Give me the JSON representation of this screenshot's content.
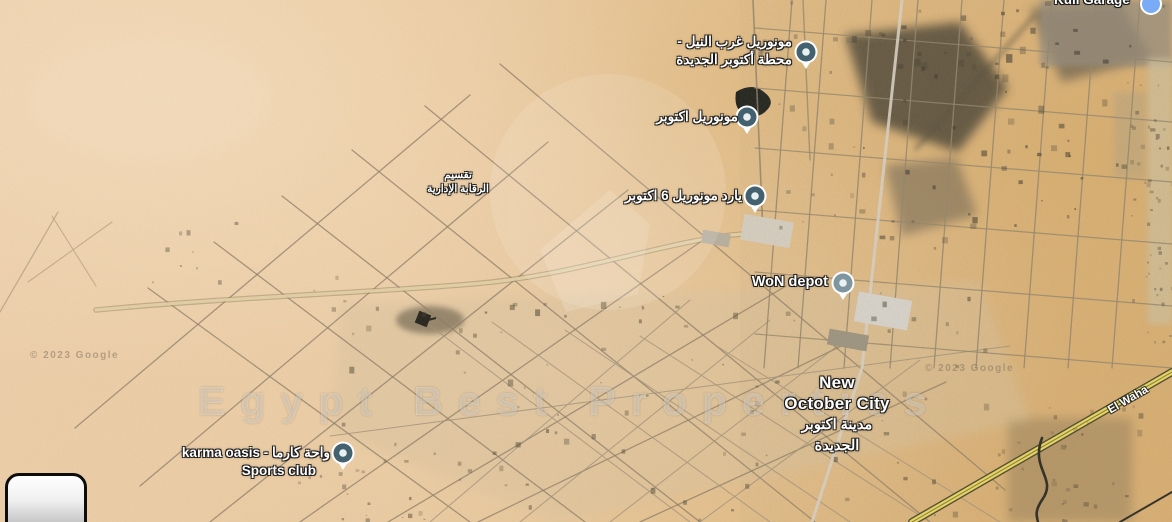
{
  "map": {
    "brand_watermark": "Egypt Best Properties",
    "credit_left": "© 2023 Google",
    "credit_right": "© 2023 Google",
    "colors": {
      "pin_slate": "#44616f",
      "pin_slate_light": "#7f95a0",
      "pin_dot": "#e9f0f2",
      "pin_ring": "#ffffff",
      "pin_blue": "#7aabf7",
      "highway_yellow": "#e9d968",
      "sand": "#ecceaa",
      "road_gray": "#95876d"
    },
    "labels": {
      "monorail_west_nile": {
        "line1": "مونوريل غرب النيل -",
        "line2": "محطة أكتوبر الجديدة"
      },
      "monorail_october": {
        "text": "مونوريل اكتوبر"
      },
      "monorail_yard": {
        "text": "يارد مونوريل 6 اكتوبر"
      },
      "won_depot": {
        "text": "WoN depot"
      },
      "new_october_city": {
        "line1": "New",
        "line2": "October City",
        "line3": "مدينة اكتوبر",
        "line4": "الجديدة"
      },
      "karma_oasis": {
        "line1": "karma oasis - واحة كارما",
        "line2": "Sports club"
      },
      "taqsim": {
        "line1": "تقسيم",
        "line2": "الرقابة الإدارية"
      },
      "kull_garage": {
        "text": "Kull Garage"
      },
      "road_el_wahat": {
        "text": "El Waha"
      }
    }
  }
}
